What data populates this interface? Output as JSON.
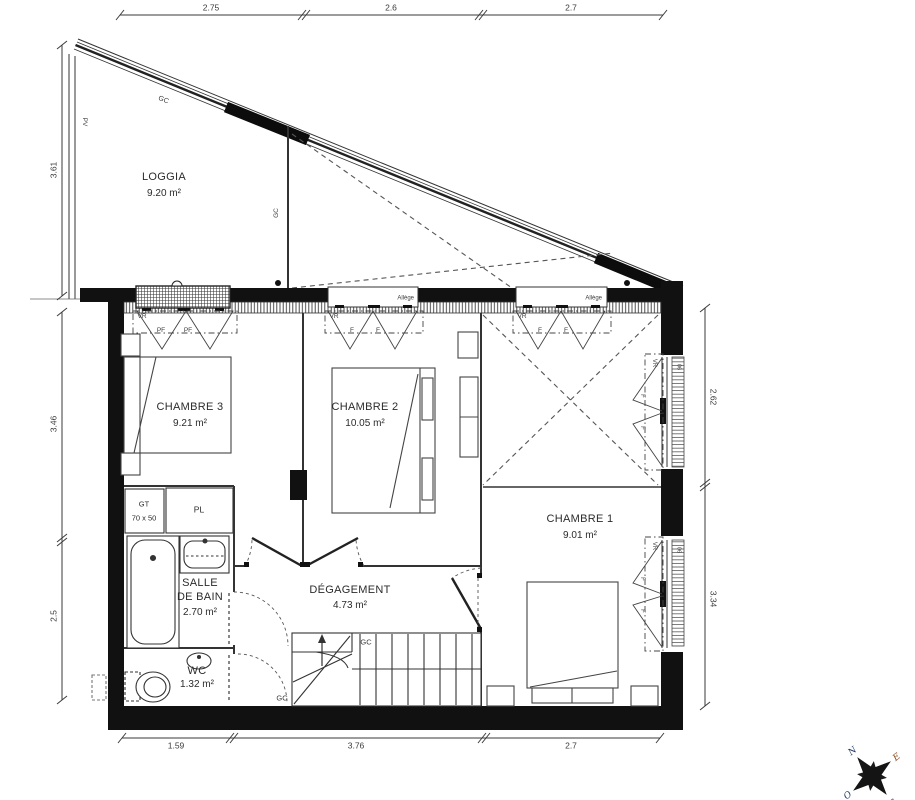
{
  "rooms": {
    "loggia": {
      "name": "LOGGIA",
      "area": "9.20 m²"
    },
    "chambre3": {
      "name": "CHAMBRE 3",
      "area": "9.21 m²"
    },
    "chambre2": {
      "name": "CHAMBRE 2",
      "area": "10.05 m²"
    },
    "chambre1": {
      "name": "CHAMBRE 1",
      "area": "9.01 m²"
    },
    "salle_de_bain": {
      "name1": "SALLE",
      "name2": "DE BAIN",
      "area": "2.70 m²"
    },
    "degagement": {
      "name": "DÉGAGEMENT",
      "area": "4.73 m²"
    },
    "wc": {
      "name": "WC",
      "area": "1.32 m²"
    }
  },
  "dimensions": {
    "top": [
      "2.75",
      "2.6",
      "2.7"
    ],
    "left": [
      "3.61",
      "3.46",
      "2.5"
    ],
    "right": [
      "2.62",
      "3.34"
    ],
    "bottom": [
      "1.59",
      "3.76",
      "2.7"
    ]
  },
  "annotations": {
    "gc": "GC",
    "pv": "PV",
    "vr": "VR",
    "pf": "PF",
    "f": "F",
    "allege": "Allège",
    "gt": "GT",
    "gt_size": "70 x 50",
    "pl": "PL",
    "shutter": "06"
  },
  "compass": {
    "n": "N",
    "e": "E",
    "s": "S",
    "o": "O"
  },
  "colors": {
    "wall": "#111111",
    "line": "#3c3c3c",
    "text": "#2b2b2b"
  }
}
